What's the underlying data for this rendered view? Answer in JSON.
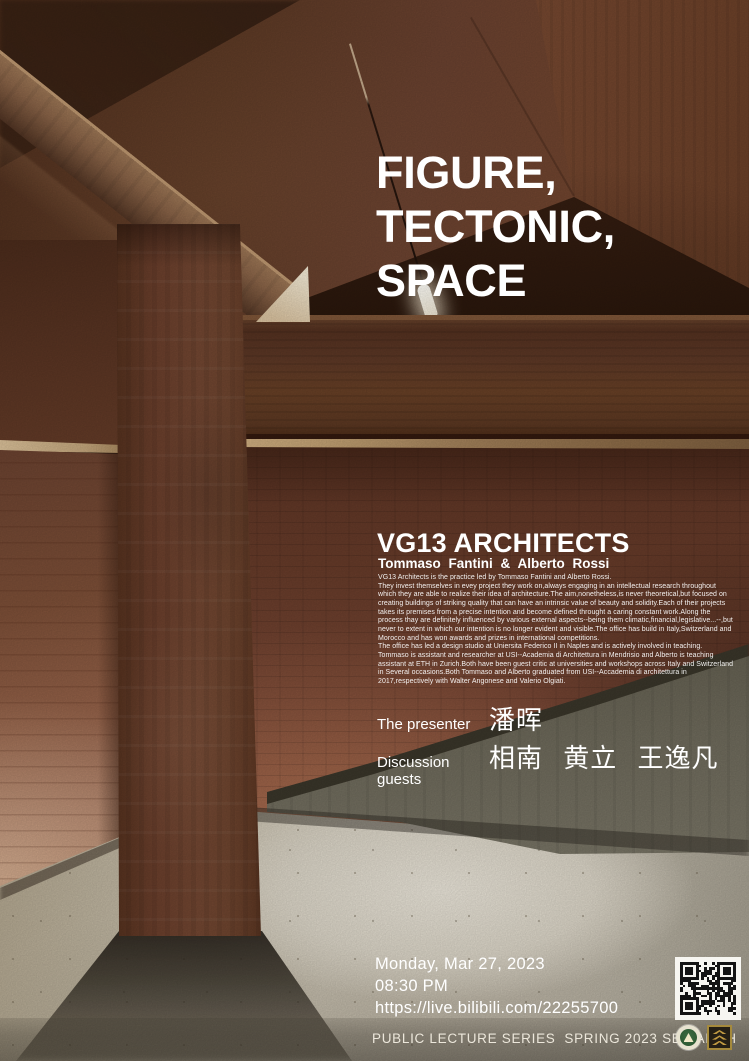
{
  "poster": {
    "title_lines": [
      "FIGURE,",
      "TECTONIC,",
      "SPACE"
    ],
    "studio": {
      "name": "VG13 ARCHITECTS",
      "principals": "Tommaso Fantini & Alberto Rossi",
      "bio": "VG13 Architects is the practice led by Tommaso Fantini and Alberto Rossi.\nThey invest themselves in evey project they work on,always engaging in an intellectual research throughout\nwhich they are able to realize their idea of architecture.The aim,nonetheless,is never theoretical,but focused on\ncreating buildings of striking quality that can have an intrinsic value of beauty and solidity.Each of their projects\ntakes its premises from a precise intention and become defined throught a caring constant work.Along the\nprocess thay are definitely influenced by various external aspects--being them climatic,financial,legislative...--,but\nnever to extent in which our intention is no longer evident and visible.The office has build in Italy,Switzerland and\nMorocco and has won awards and prizes in international competitions.\nThe office has led a design studio at Uniersita Federico II in Naples and is actively involved in teaching.\nTommaso is assistant and researcher at USI--Academia di Architettura in Mendrisio and Alberto is teaching\nassistant at ETH in Zurich.Both have been guest critic at universities and workshops across Italy and Switzerland\nin Several occasions.Both Tommaso and Alberto graduated from USI--Accademia di architettura in\n2017,respectively with Walter Angonese and Valerio Olgiati."
    },
    "people": {
      "presenter_label": "The presenter",
      "presenter_name": "潘晖",
      "guests_label": "Discussion guests",
      "guests_names": "相南 黄立 王逸凡"
    },
    "event": {
      "date": "Monday, Mar 27, 2023",
      "time": "08:30 PM",
      "url": "https://live.bilibili.com/22255700"
    },
    "footer": {
      "series_label": "PUBLIC LECTURE SERIES  SPRING 2023 SEU ARCH"
    },
    "icons": {
      "qr": "qr-code",
      "seal": "seu-seal-logo",
      "arch": "seu-arch-logo"
    },
    "colors": {
      "text": "#ffffff",
      "qr_dark": "#141414",
      "seal_green": "#2e5a33",
      "arch_gold": "#c09a42"
    }
  }
}
